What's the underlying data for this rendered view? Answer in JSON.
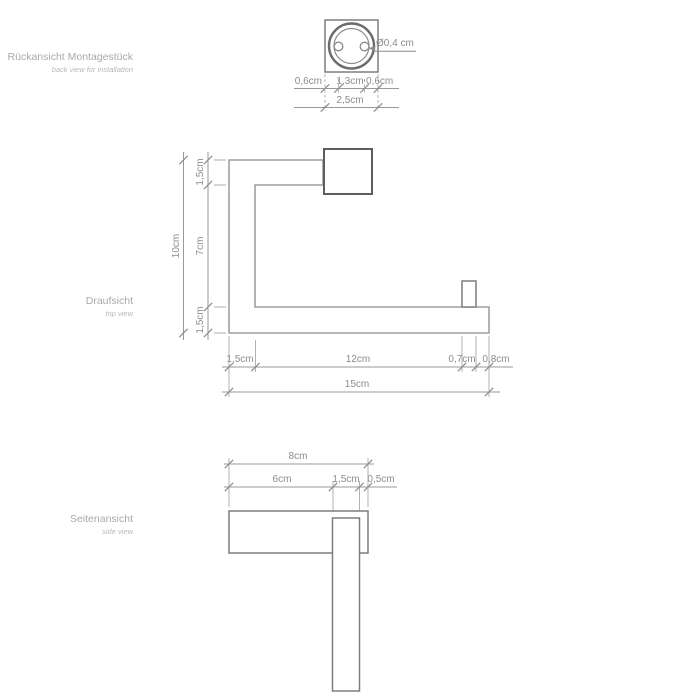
{
  "colors": {
    "background": "#ffffff",
    "line": "#8a8a8a",
    "dark_line": "#5e5e5e",
    "section_label": "#a9a9a9",
    "dimension_text": "#8c8c8c"
  },
  "back_view": {
    "label": "Rückansicht Montagestück",
    "sublabel": "back view for installation",
    "hole_diameter": "Ø0,4 cm",
    "dim_left": "0,6cm",
    "dim_center": "1,3cm",
    "dim_right": "0,6cm",
    "dim_total": "2,5cm"
  },
  "top_view": {
    "label": "Draufsicht",
    "sublabel": "top view",
    "dim_height_total": "10cm",
    "dim_height_top": "1,5cm",
    "dim_height_mid": "7cm",
    "dim_height_bottom": "1,5cm",
    "dim_len_seg1": "1,5cm",
    "dim_len_seg2": "12cm",
    "dim_len_seg3": "0,7cm",
    "dim_len_seg4": "0,8cm",
    "dim_len_total": "15cm"
  },
  "side_view": {
    "label": "Seitenansicht",
    "sublabel": "side view",
    "dim_depth_total": "8cm",
    "dim_depth_seg1": "6cm",
    "dim_depth_seg2": "1,5cm",
    "dim_depth_seg3": "0,5cm"
  }
}
